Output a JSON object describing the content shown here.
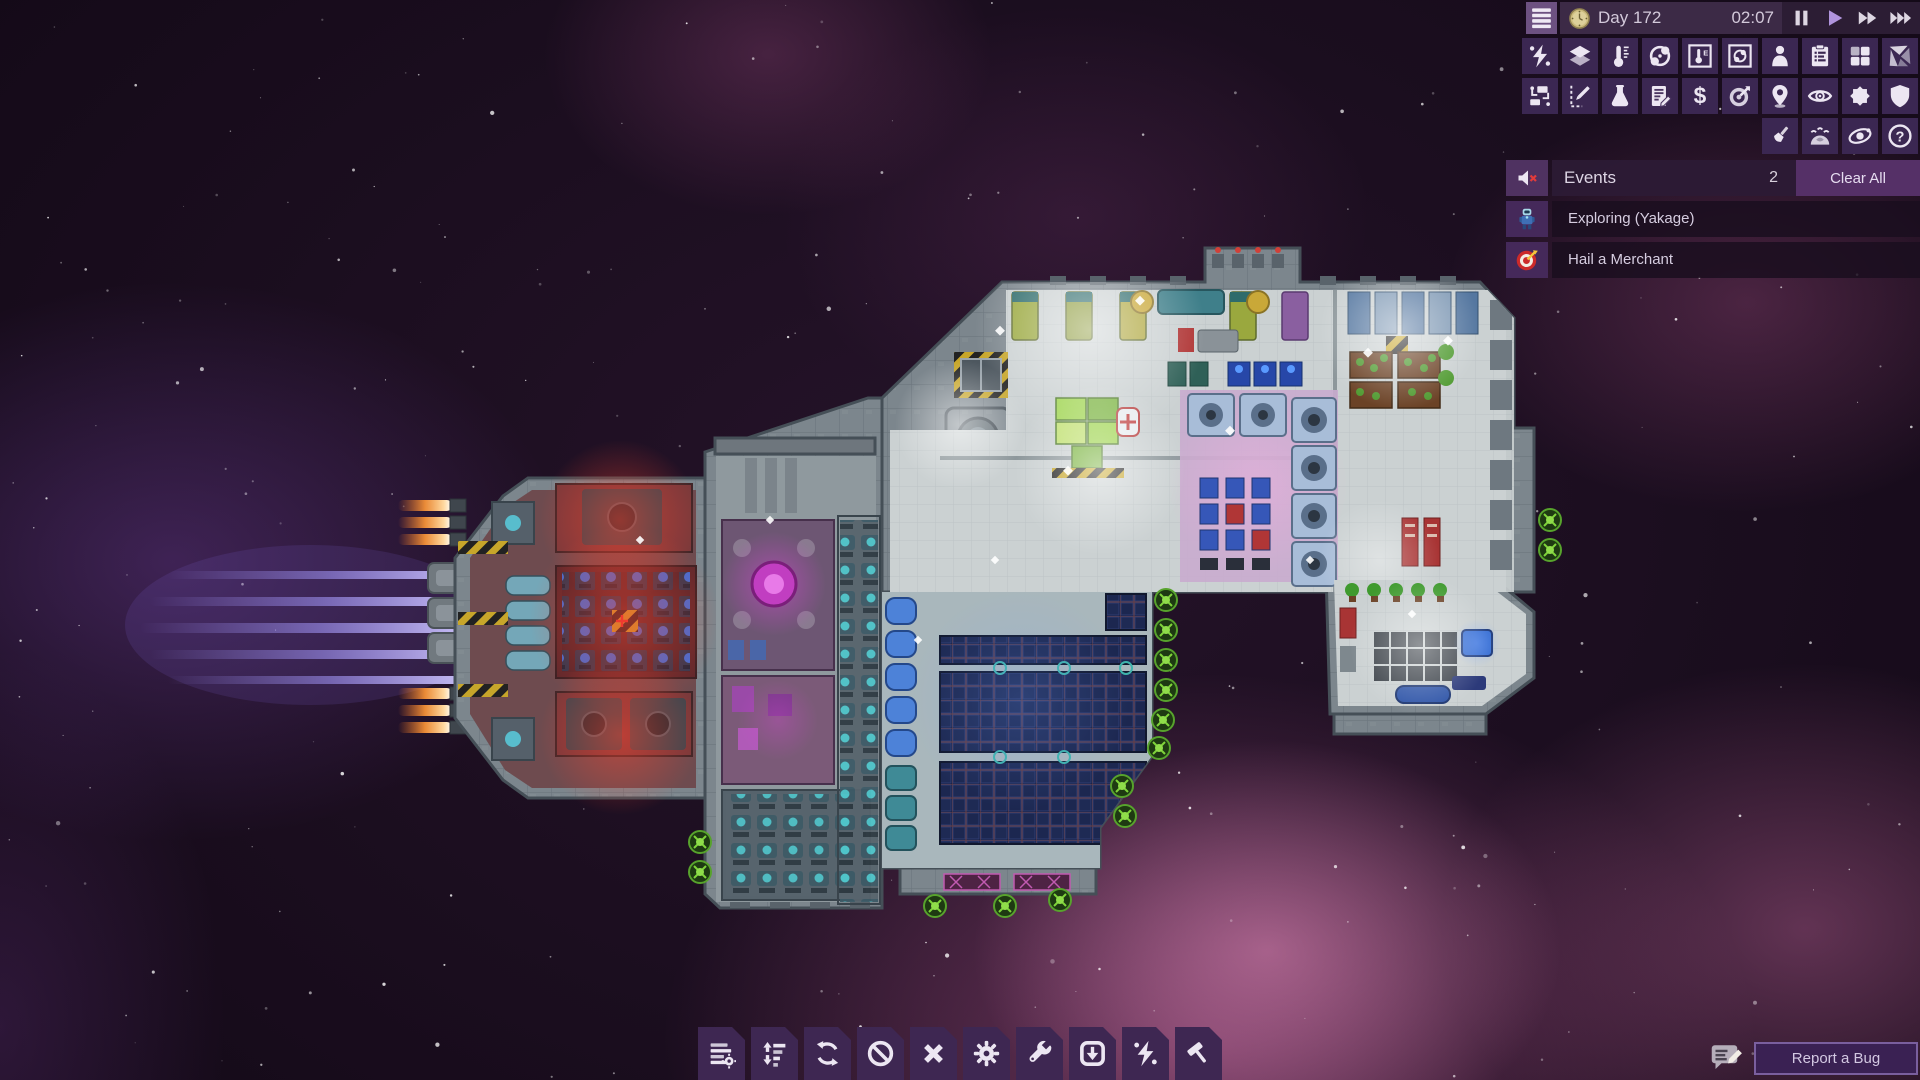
{
  "hud": {
    "menu": {
      "name": "main-menu-button",
      "icon": "menu"
    },
    "day_label": "Day 172",
    "time": "02:07",
    "clock_icon": "clock",
    "playback": [
      {
        "name": "pause-button",
        "icon": "pause",
        "active": false
      },
      {
        "name": "play-button",
        "icon": "play",
        "active": true
      },
      {
        "name": "fast-forward-button",
        "icon": "ff",
        "active": false
      },
      {
        "name": "fastest-forward-button",
        "icon": "fff",
        "active": false
      }
    ]
  },
  "overlay_toolbar": {
    "row1": [
      {
        "name": "power-overlay-button",
        "icon": "power"
      },
      {
        "name": "floor-overlay-button",
        "icon": "tiles"
      },
      {
        "name": "temperature-overlay-button",
        "icon": "thermometer"
      },
      {
        "name": "gas-overlay-button",
        "icon": "gas"
      },
      {
        "name": "temperature-detail-button",
        "icon": "thermo-box"
      },
      {
        "name": "gas-detail-button",
        "icon": "gas-box"
      },
      {
        "name": "crew-button",
        "icon": "person"
      },
      {
        "name": "crew-list-button",
        "icon": "clipboard"
      },
      {
        "name": "rooms-button",
        "icon": "grid4"
      },
      {
        "name": "hull-sections-button",
        "icon": "hull-split"
      }
    ],
    "row2": [
      {
        "name": "logistics-button",
        "icon": "logistics"
      },
      {
        "name": "draw-mode-button",
        "icon": "draw"
      },
      {
        "name": "research-button",
        "icon": "flask"
      },
      {
        "name": "contracts-button",
        "icon": "contract"
      },
      {
        "name": "trade-button",
        "icon": "dollar"
      },
      {
        "name": "missions-button",
        "icon": "missions"
      },
      {
        "name": "navigation-button",
        "icon": "pin"
      },
      {
        "name": "visibility-button",
        "icon": "eye"
      },
      {
        "name": "combat-button",
        "icon": "burst"
      },
      {
        "name": "shields-button",
        "icon": "shield"
      }
    ],
    "row3": [
      {
        "name": "customize-button",
        "icon": "brush"
      },
      {
        "name": "hibernation-button",
        "icon": "dome"
      },
      {
        "name": "system-view-button",
        "icon": "system"
      },
      {
        "name": "help-button",
        "icon": "help"
      }
    ]
  },
  "events": {
    "mute_icon": "speaker-muted",
    "title": "Events",
    "count": "2",
    "clear_all_label": "Clear All",
    "items": [
      {
        "name": "event-exploring",
        "icon": "explorer",
        "label": "Exploring (Yakage)"
      },
      {
        "name": "event-hail-merchant",
        "icon": "target-event",
        "label": "Hail a Merchant"
      }
    ]
  },
  "bottom_toolbar": [
    {
      "name": "manage-lists-button",
      "icon": "manage"
    },
    {
      "name": "priorities-button",
      "icon": "priorities"
    },
    {
      "name": "rotate-button",
      "icon": "rotate"
    },
    {
      "name": "forbid-button",
      "icon": "forbid"
    },
    {
      "name": "cancel-button",
      "icon": "cancel"
    },
    {
      "name": "operations-button",
      "icon": "gear"
    },
    {
      "name": "repair-button",
      "icon": "wrench"
    },
    {
      "name": "deploy-button",
      "icon": "deploy"
    },
    {
      "name": "power-management-button",
      "icon": "power"
    },
    {
      "name": "build-button",
      "icon": "build"
    }
  ],
  "bug_report": {
    "name": "report-a-bug-button",
    "icon": "bug",
    "label": "Report a Bug"
  },
  "colors": {
    "accent_play": "#b094dd",
    "tile_bg": "#3b2752",
    "events_header_bg": "#2c1b35",
    "clear_button_bg": "#553067",
    "report_border": "#7a5f9e",
    "nebula_pink": "#d769aa",
    "engine_trail": "#a79bff"
  }
}
